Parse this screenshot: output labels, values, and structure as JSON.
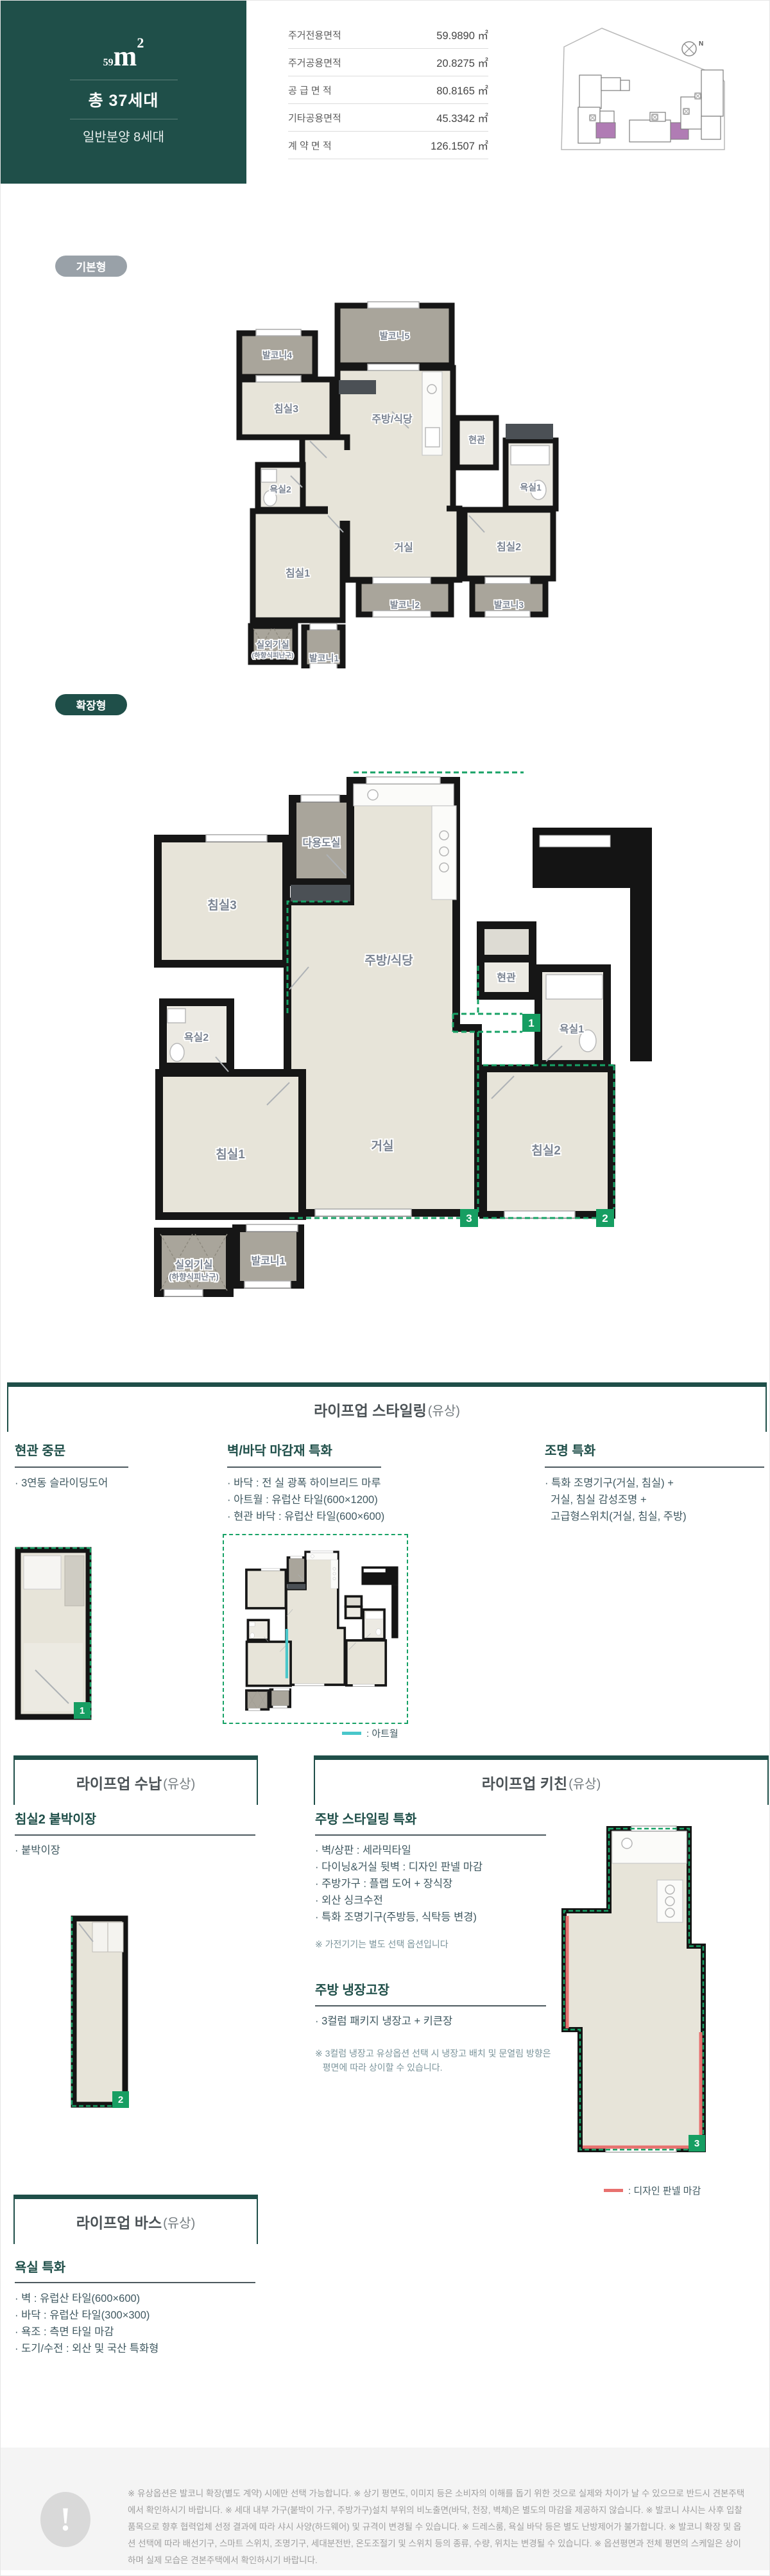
{
  "header": {
    "area_number": "59",
    "area_unit": "m",
    "area_sup": "2",
    "total_units": "총 37세대",
    "general_sale": "일반분양 8세대",
    "table": {
      "rows": [
        {
          "label": "주거전용면적",
          "value": "59.9890 ㎡"
        },
        {
          "label": "주거공용면적",
          "value": "20.8275 ㎡"
        },
        {
          "label": "공 급 면 적",
          "value": "80.8165 ㎡"
        },
        {
          "label": "기타공용면적",
          "value": "45.3342 ㎡"
        },
        {
          "label": "계 약 면 적",
          "value": "126.1507 ㎡"
        }
      ]
    }
  },
  "badges": {
    "basic": "기본형",
    "extended": "확장형"
  },
  "rooms": {
    "bed1": "침실1",
    "bed2": "침실2",
    "bed3": "침실3",
    "living": "거실",
    "kitchen": "주방/식당",
    "entry": "현관",
    "bath1": "욕실1",
    "bath2": "욕실2",
    "utility": "다용도실",
    "balcony1": "발코니1",
    "balcony2": "발코니2",
    "balcony3": "발코니3",
    "balcony4": "발코니4",
    "balcony5": "발코니5",
    "outdoor": "실외기실",
    "outdoor_sub": "(하향식피난구)",
    "marker1": "1",
    "marker2": "2",
    "marker3": "3"
  },
  "sections": {
    "styling": {
      "title": "라이프업 스타일링",
      "title_paren": "(유상)",
      "cols": [
        {
          "heading": "현관 중문",
          "bullets_text": "· 3연동 슬라이딩도어"
        },
        {
          "heading": "벽/바닥 마감재 특화",
          "bullets_text": "· 바닥 : 전 실 광폭 하이브리드 마루\n· 아트월 : 유럽산 타일(600×1200)\n· 현관 바닥 : 유럽산 타일(600×600)"
        },
        {
          "heading": "조명 특화",
          "bullets_text": "· 특화 조명기구(거실, 침실) +\n  거실, 침실 감성조명 +\n  고급형스위치(거실, 침실, 주방)"
        }
      ],
      "artwall_legend": ": 아트월"
    },
    "storage": {
      "title": "라이프업 수납",
      "title_paren": "(유상)",
      "heading": "침실2 붙박이장",
      "bullets_text": "· 붙박이장"
    },
    "kitchen": {
      "title": "라이프업 키친",
      "title_paren": "(유상)",
      "group1_heading": "주방 스타일링 특화",
      "group1_bullets_text": "· 벽/상판 : 세라믹타일\n· 다이닝&거실 뒷벽 : 디자인 판넬 마감\n· 주방가구 : 플랩 도어 + 장식장\n· 외산 싱크수전\n· 특화 조명기구(주방등, 식탁등 변경)",
      "group1_note": "※ 가전기기는 별도 선택 옵션입니다",
      "group2_heading": "주방 냉장고장",
      "group2_bullets_text": "· 3컬럼 패키지 냉장고 + 키큰장",
      "group2_note": "※ 3컬럼 냉장고 유상옵션 선택 시 냉장고 배치 및 문열림 방향은\n   평면에 따라 상이할 수 있습니다.",
      "panel_legend": ": 디자인 판넬 마감"
    },
    "bath": {
      "title": "라이프업 바스",
      "title_paren": "(유상)",
      "heading": "욕실 특화",
      "bullets_text": "· 벽 : 유럽산 타일(600×600)\n· 바닥 : 유럽산 타일(300×300)\n· 욕조 : 측면 타일 마감\n· 도기/수전 : 외산 및 국산 특화형"
    }
  },
  "footer": {
    "disclaimer": "※ 유상옵션은 발코니 확장(별도 계약) 시에만 선택 가능합니다. ※ 상기 평면도, 이미지 등은 소비자의 이해를 돕기 위한 것으로 실제와 차이가 날 수 있으므로 반드시 견본주택에서 확인하시기 바랍니다. ※ 세대 내부 가구(붙박이 가구, 주방가구)설치 부위의 비노출면(바닥, 천장, 벽체)은 별도의 마감을 제공하지 않습니다. ※ 발코니 샤시는 사후 입찰품목으로 향후 협력업체 선정 결과에 따라 샤시 사양(하드웨어) 및 규격이 변경될 수 있습니다. ※ 드레스룸, 욕실 바닥 등은 별도 난방제어가 불가합니다. ※ 발코니 확장 및 옵션 선택에 따라 배선기구, 스마트 스위치, 조명기구, 세대분전반, 온도조절기 및 스위치 등의 종류, 수량, 위치는 변경될 수 있습니다. ※ 옵션평면과 전체 평면의 스케일은 상이하며 실제 모습은 견본주택에서 확인하시기 바랍니다."
  },
  "colors": {
    "accent_teal": "#1f4f49",
    "badge_gray": "#99a1a8",
    "expansion_green": "#17a266",
    "artwall_cyan": "#49c7ca",
    "panel_red": "#e8716f",
    "unit_purple": "#b07cb4"
  }
}
